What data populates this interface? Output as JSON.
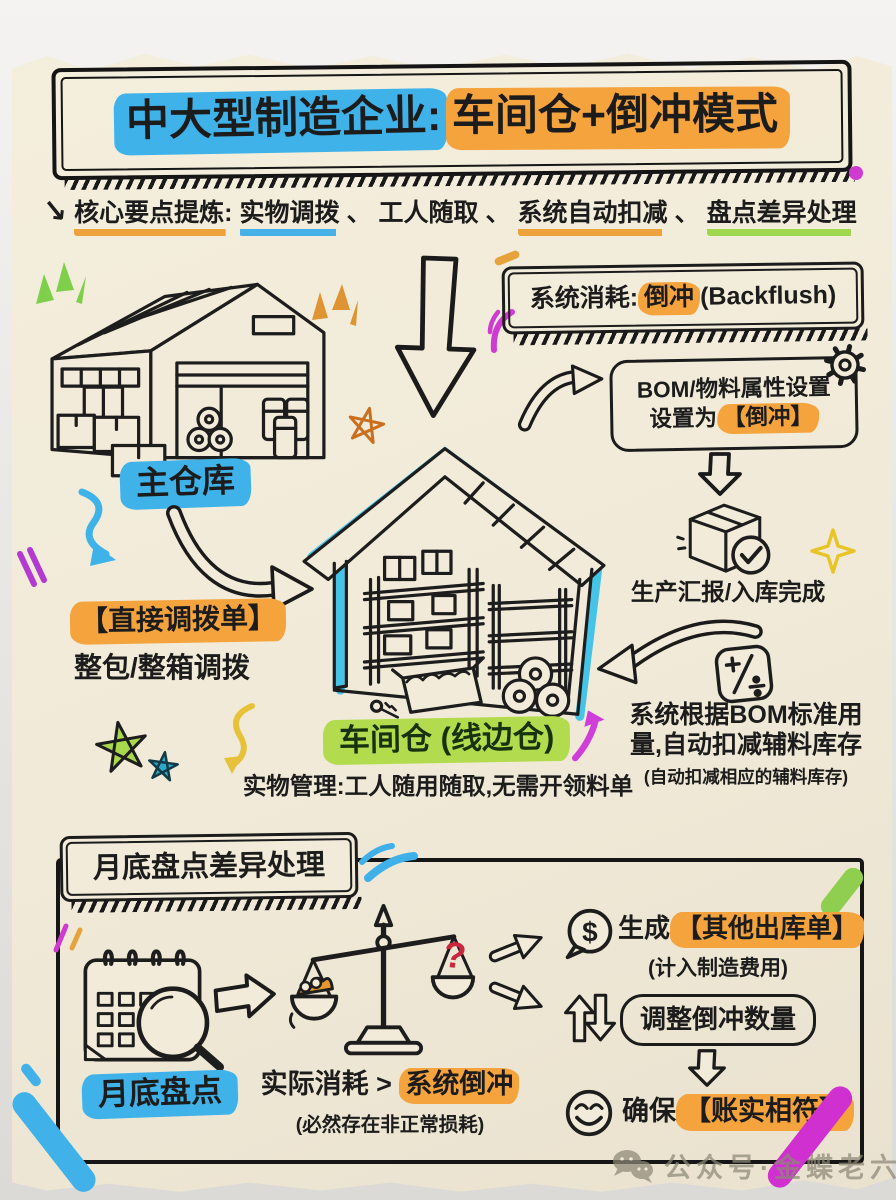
{
  "title": {
    "blue": "中大型制造企业:",
    "orange": "车间仓+倒冲模式"
  },
  "subtitle": {
    "lead": "核心要点提炼:",
    "seg1": "实物调拨",
    "sep1": "、",
    "seg2": "工人随取",
    "sep2": "、",
    "seg3": "系统自动扣减",
    "sep3": "、",
    "seg4": "盘点差异处理"
  },
  "flow": {
    "main_warehouse_label": "主仓库",
    "system_consume": {
      "prefix": "系统消耗:",
      "highlight": "倒冲",
      "suffix": "(Backflush)"
    },
    "bom": {
      "line1": "BOM/物料属性设置",
      "line2_prefix": "设置为",
      "line2_highlight": "【倒冲】"
    },
    "report_done": "生产汇报/入库完成",
    "deduct": {
      "line1": "系统根据BOM标准用",
      "line2": "量,自动扣减辅料库存",
      "note": "(自动扣减相应的辅料库存)"
    },
    "transfer": {
      "highlight": "【直接调拨单】",
      "desc": "整包/整箱调拨"
    },
    "workshop": {
      "label": "车间仓 (线边仓)",
      "desc": "实物管理:工人随用随取,无需开领料单"
    }
  },
  "bottom": {
    "header": "月底盘点差异处理",
    "calendar_label": "月底盘点",
    "compare": {
      "left": "实际消耗 >",
      "highlight": "系统倒冲",
      "note": "(必然存在非正常损耗)"
    },
    "generate": {
      "prefix": "生成",
      "highlight": "【其他出库单】",
      "note": "(计入制造费用)"
    },
    "adjust_label": "调整倒冲数量",
    "ensure": {
      "prefix": "确保",
      "highlight": "【账实相符】"
    }
  },
  "footer": {
    "watermark": "公众号·金蝶老六"
  },
  "icons": {
    "subtitle_arrow": "↘",
    "dollar": "$",
    "question": "?"
  },
  "colors": {
    "highlight_blue": "#3fb3e9",
    "highlight_orange": "#f5a33c",
    "highlight_green": "#b2dc4e",
    "paper": "#f2ebd9",
    "ink": "#1c1c1c",
    "question_red": "#c9273e"
  }
}
